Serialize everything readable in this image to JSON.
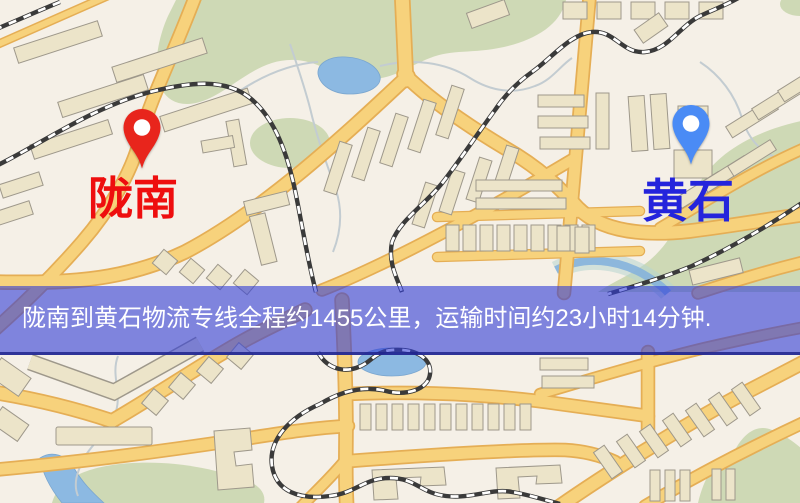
{
  "map": {
    "origin": {
      "label": "陇南",
      "pin_color": "#e8251c",
      "label_color": "#ee0e0e"
    },
    "destination": {
      "label": "黄石",
      "pin_color": "#4a8bf5",
      "label_color": "#2424dc"
    }
  },
  "banner": {
    "text": "陇南到黄石物流专线全程约1455公里，运输时间约23小时14分钟.",
    "background": "rgba(48,60,215,0.60)",
    "border_bottom_color": "#23288f",
    "text_color": "#ffffff"
  },
  "palette": {
    "map_background": "#f5f0e7",
    "road_fill": "#f7d27c",
    "road_casing": "#e5ae55",
    "railway_dark": "#3a3a3a",
    "railway_dash": "#ffffff",
    "water": "#8cb9e2",
    "green_area": "#cbd7b2",
    "building_fill": "#ece4c9",
    "building_stroke": "#9e988b"
  }
}
